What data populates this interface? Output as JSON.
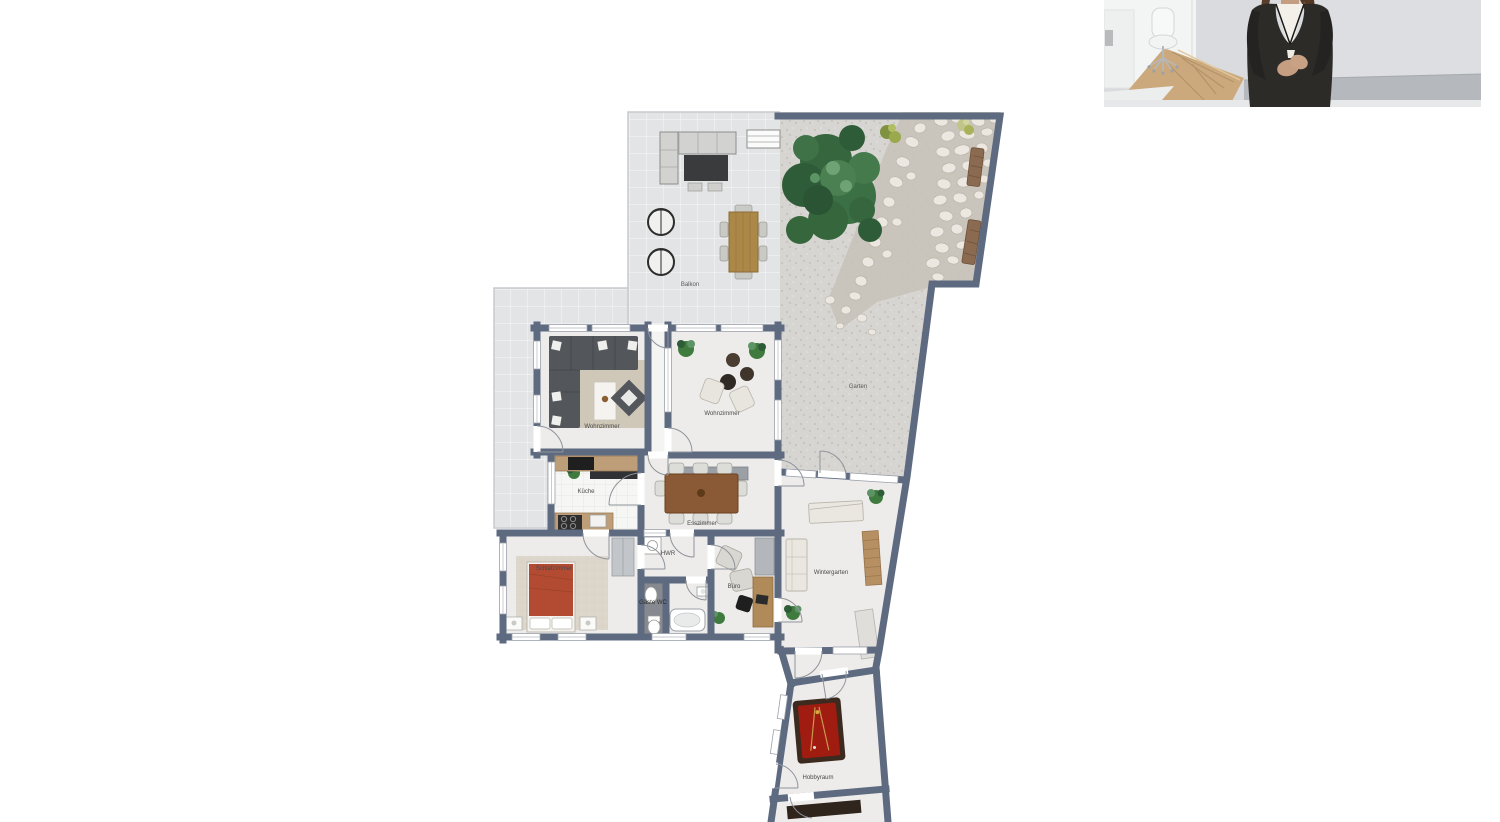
{
  "photo": {
    "alt": "Maklerin im Büro",
    "bg": "#d9dbde",
    "floor_band": "#b5b8bc",
    "suit": "#2c2b28",
    "blouse": "#f3f0e9",
    "skin": "#c59d81",
    "hair": "#5a3c2a",
    "wood_floor": "#cba97c"
  },
  "floorplan": {
    "colors": {
      "wall": "#5d6a80",
      "room_floor": "#edecea",
      "balcony_tile": "#e3e4e6",
      "garden_gravel": "#d7d5d1",
      "stone": "#ece7e0",
      "tree": "#3b6f44",
      "bed": "#b24b31",
      "billiard": "#a01c10",
      "wood": "#bd9e78"
    },
    "rooms": [
      {
        "id": "balkon",
        "label": "Balkon"
      },
      {
        "id": "garten",
        "label": "Garten"
      },
      {
        "id": "wohnzimmer-links",
        "label": "Wohnzimmer"
      },
      {
        "id": "wohnzimmer-rechts",
        "label": "Wohnzimmer"
      },
      {
        "id": "kueche",
        "label": "Küche"
      },
      {
        "id": "esszimmer",
        "label": "Esszimmer"
      },
      {
        "id": "schlafzimmer",
        "label": "Schlafzimmer"
      },
      {
        "id": "hwr",
        "label": "HWR"
      },
      {
        "id": "gaeste-wc",
        "label": "Gäste WC"
      },
      {
        "id": "buero",
        "label": "Büro"
      },
      {
        "id": "wintergarten",
        "label": "Wintergarten"
      },
      {
        "id": "hobbyraum",
        "label": "Hobbyraum"
      }
    ]
  }
}
